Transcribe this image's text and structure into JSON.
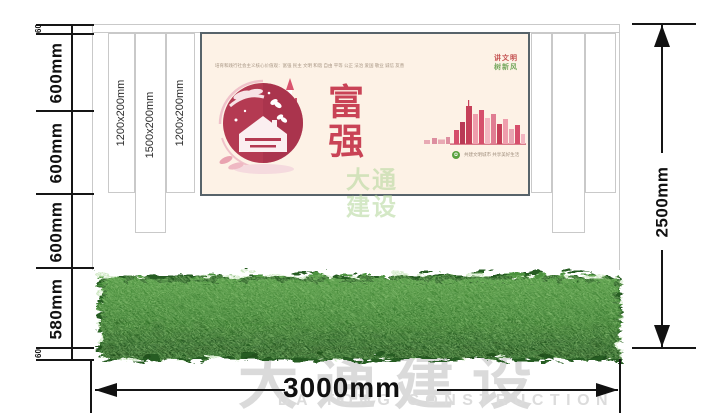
{
  "dimensions": {
    "left": [
      "60",
      "600mm",
      "600mm",
      "600mm",
      "580mm",
      "60"
    ],
    "right": "2500mm",
    "bottom": "3000mm"
  },
  "panels": [
    "1200x200mm",
    "1500x200mm",
    "1200x200mm"
  ],
  "poster": {
    "header_line": "培育和践行社会主义核心价值观：富强 民主 文明 和谐 自由 平等 公正 法治 爱国 敬业 诚信 友善",
    "slogan_1": "讲文明",
    "slogan_2": "树新风",
    "main_text": "富强",
    "footer_text": "共建文明城市 共享美好生活"
  },
  "watermarks": {
    "poster_line1": "大通",
    "poster_line2": "建设",
    "bottom_cn": "大通建设",
    "bottom_en": "DA TONG CONSTRUCTION"
  },
  "colors": {
    "dim_line": "#151515",
    "wall_outline": "#c9c9c9",
    "poster_bg": "#fdf2e6",
    "accent_red": "#c94356",
    "accent_green": "#76a85e",
    "hedge_green": "#3a7d2e",
    "watermark_gray": "#dadada"
  }
}
